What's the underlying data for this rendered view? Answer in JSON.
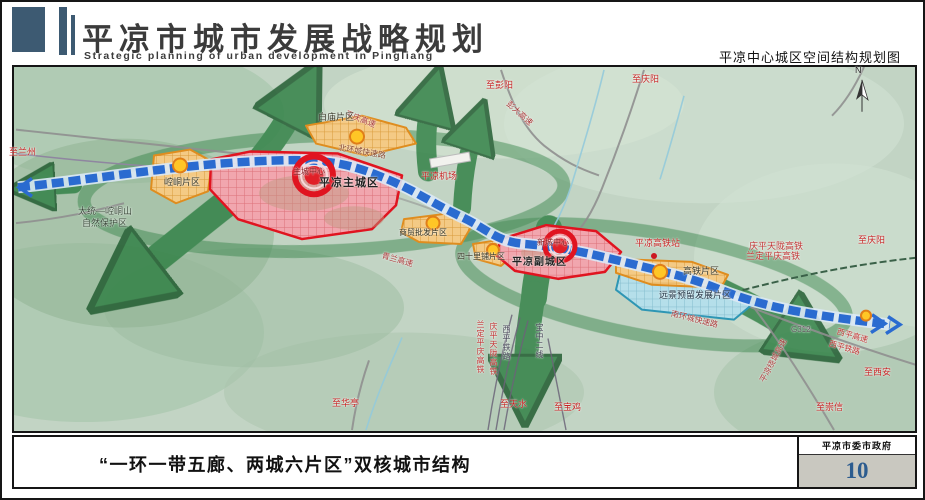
{
  "header": {
    "title": "平凉市城市发展战略规划",
    "subtitle": "Strategic planning of urban development in Pingliang",
    "map_title": "平凉中心城区空间结构规划图"
  },
  "map": {
    "compass_label": "N",
    "labels": [
      {
        "text": "至兰州",
        "x": 7,
        "y": 146,
        "color": "#c52222",
        "size": 9
      },
      {
        "text": "至彭阳",
        "x": 484,
        "y": 79,
        "color": "#c52222",
        "size": 9
      },
      {
        "text": "至庆阳",
        "x": 630,
        "y": 73,
        "color": "#c52222",
        "size": 9
      },
      {
        "text": "彭大高速",
        "x": 508,
        "y": 98,
        "color": "#a83838",
        "size": 8,
        "rot": 42
      },
      {
        "text": "平庆高速",
        "x": 345,
        "y": 108,
        "color": "#a83838",
        "size": 8,
        "rot": 22
      },
      {
        "text": "白庙片区",
        "x": 316,
        "y": 111,
        "color": "#333322",
        "size": 9
      },
      {
        "text": "北环城快速路",
        "x": 337,
        "y": 142,
        "color": "#84432a",
        "size": 8,
        "rot": 10
      },
      {
        "text": "主城中心",
        "x": 291,
        "y": 166,
        "color": "#7d0f14",
        "size": 8
      },
      {
        "text": "平凉主城区",
        "x": 317,
        "y": 176,
        "color": "#222222",
        "size": 11,
        "bold": true
      },
      {
        "text": "崆峒片区",
        "x": 162,
        "y": 176,
        "color": "#333322",
        "size": 9
      },
      {
        "text": "太统—崆峒山",
        "x": 76,
        "y": 205,
        "color": "#3a4a3a",
        "size": 9
      },
      {
        "text": "自然保护区",
        "x": 80,
        "y": 217,
        "color": "#3a4a3a",
        "size": 9
      },
      {
        "text": "平凉机场",
        "x": 419,
        "y": 170,
        "color": "#c52222",
        "size": 9
      },
      {
        "text": "商贸批发片区",
        "x": 397,
        "y": 227,
        "color": "#333322",
        "size": 8
      },
      {
        "text": "青兰高速",
        "x": 381,
        "y": 250,
        "color": "#a83838",
        "size": 8,
        "rot": 16
      },
      {
        "text": "四十里铺片区",
        "x": 455,
        "y": 251,
        "color": "#333322",
        "size": 8
      },
      {
        "text": "新城中心",
        "x": 535,
        "y": 237,
        "color": "#7d0f14",
        "size": 8
      },
      {
        "text": "平凉副城区",
        "x": 510,
        "y": 256,
        "color": "#222222",
        "size": 10,
        "bold": true
      },
      {
        "text": "平凉高铁站",
        "x": 633,
        "y": 237,
        "color": "#c52222",
        "size": 9
      },
      {
        "text": "庆平天陇高铁",
        "x": 747,
        "y": 240,
        "color": "#c03333",
        "size": 9
      },
      {
        "text": "兰定平庆高铁",
        "x": 744,
        "y": 250,
        "color": "#c03333",
        "size": 9
      },
      {
        "text": "至庆阳",
        "x": 856,
        "y": 234,
        "color": "#c52222",
        "size": 9
      },
      {
        "text": "高铁片区",
        "x": 681,
        "y": 265,
        "color": "#333322",
        "size": 9
      },
      {
        "text": "远景预留发展片区",
        "x": 657,
        "y": 289,
        "color": "#223344",
        "size": 9
      },
      {
        "text": "南环城快速路",
        "x": 670,
        "y": 308,
        "color": "#a83838",
        "size": 8,
        "rot": 14
      },
      {
        "text": "G312",
        "x": 789,
        "y": 324,
        "color": "#555555",
        "size": 8
      },
      {
        "text": "西平高速",
        "x": 836,
        "y": 326,
        "color": "#c03333",
        "size": 8,
        "rot": 16
      },
      {
        "text": "西平铁路",
        "x": 828,
        "y": 338,
        "color": "#c03333",
        "size": 8,
        "rot": 16
      },
      {
        "text": "至西安",
        "x": 862,
        "y": 366,
        "color": "#c52222",
        "size": 9
      },
      {
        "text": "至崇信",
        "x": 814,
        "y": 401,
        "color": "#c52222",
        "size": 9
      },
      {
        "text": "平凉绕城高速",
        "x": 757,
        "y": 378,
        "color": "#a83838",
        "size": 8,
        "rot": -62
      },
      {
        "text": "至华亭",
        "x": 330,
        "y": 397,
        "color": "#c52222",
        "size": 9
      },
      {
        "text": "至天水",
        "x": 498,
        "y": 398,
        "color": "#c52222",
        "size": 9
      },
      {
        "text": "至宝鸡",
        "x": 552,
        "y": 401,
        "color": "#c52222",
        "size": 9
      },
      {
        "text": "兰定平庆高铁",
        "x": 474,
        "y": 318,
        "color": "#c03333",
        "size": 8,
        "vertical": true
      },
      {
        "text": "庆平天陇高铁",
        "x": 487,
        "y": 320,
        "color": "#c03333",
        "size": 8,
        "vertical": true
      },
      {
        "text": "西平铁路",
        "x": 500,
        "y": 323,
        "color": "#444455",
        "size": 8,
        "vertical": true
      },
      {
        "text": "宝中二线",
        "x": 533,
        "y": 321,
        "color": "#444455",
        "size": 8,
        "vertical": true
      },
      {
        "text": "N",
        "x": 853,
        "y": 64,
        "color": "#222222",
        "size": 9
      }
    ]
  },
  "footer": {
    "caption": "“一环一带五廊、两城六片区”双核城市结构",
    "agency": "平凉市委市政府",
    "page_number": "10"
  },
  "colors": {
    "header_accent": "#3d5a72",
    "eco_green": "#2f7f44",
    "axis_blue": "#2a6bd0",
    "city_red": "#e01420",
    "district_orange": "#df8d1f",
    "reserve_blue": "#2e96b4",
    "page_number_blue": "#2c5c8f"
  }
}
